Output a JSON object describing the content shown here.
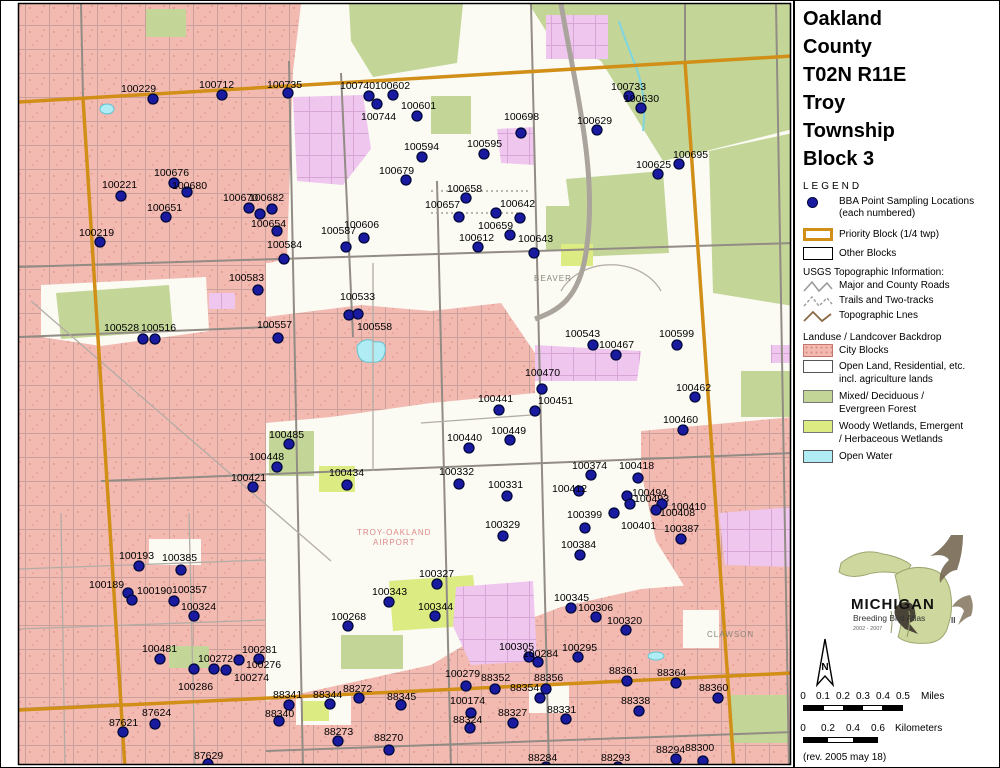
{
  "title": {
    "lines": [
      "Oakland",
      "County",
      "T02N R11E",
      "Troy",
      "Township",
      "Block 3"
    ]
  },
  "legend": {
    "heading": "LEGEND",
    "bba_label": "BBA Point Sampling Locations",
    "bba_sublabel": "(each numbered)",
    "priority_block": "Priority Block (1/4 twp)",
    "other_blocks": "Other Blocks",
    "usgs_heading": "USGS Topographic Information:",
    "usgs_items": [
      "Major and County Roads",
      "Trails and Two-tracks",
      "Topographic Lnes"
    ],
    "landuse_heading": "Landuse / Landcover Backdrop",
    "landuse_items": [
      {
        "label": "City Blocks",
        "color": "#f3bab2"
      },
      {
        "label": "Open Land, Residential, etc.",
        "label2": "incl. agriculture lands",
        "color": "#ffffff"
      },
      {
        "label": "Mixed/ Deciduous /",
        "label2": "Evergreen Forest",
        "color": "#c3d698"
      },
      {
        "label": "Woody Wetlands, Emergent",
        "label2": "/ Herbaceous Wetlands",
        "color": "#dceb82"
      },
      {
        "label": "Open Water",
        "color": "#b0ecf4"
      }
    ]
  },
  "logo": {
    "name": "MICHIGAN",
    "subtitle": "Breeding Bird Atlas",
    "years": "2002 - 2007",
    "numeral": "II"
  },
  "north": {
    "label": "N"
  },
  "scalebars": {
    "miles": {
      "ticks": [
        "0",
        "0.1",
        "0.2",
        "0.3",
        "0.4",
        "0.5"
      ],
      "unit": "Miles"
    },
    "km": {
      "ticks": [
        "0",
        "0.2",
        "0.4",
        "0.6"
      ],
      "unit": "Kilometers"
    }
  },
  "revision": "(rev. 2005 may 18)",
  "colors": {
    "priority_block": "#d18f17",
    "point_dot": "#1a1aa0",
    "city_block": "#f3bab2",
    "forest": "#c3d698",
    "wetland": "#dcEB82",
    "water": "#b0ecf4",
    "violet": "#eec6ee"
  },
  "map": {
    "place_labels": [
      {
        "text": "BEAVER",
        "x": 533,
        "y": 280,
        "color": "#8a8478"
      },
      {
        "text": "TROY-OAKLAND",
        "x": 356,
        "y": 534,
        "color": "#d88"
      },
      {
        "text": "AIRPORT",
        "x": 372,
        "y": 544,
        "color": "#d88"
      },
      {
        "text": "CLAWSON",
        "x": 706,
        "y": 636,
        "color": "#8a8478"
      }
    ],
    "extra_dots": [
      {
        "x": 495,
        "y": 212
      },
      {
        "x": 259,
        "y": 213
      }
    ],
    "points": [
      {
        "id": "100229",
        "x": 152,
        "y": 98,
        "lx": 120,
        "ly": 82
      },
      {
        "id": "100712",
        "x": 221,
        "y": 94,
        "lx": 198,
        "ly": 78
      },
      {
        "id": "100735",
        "x": 287,
        "y": 92,
        "lx": 266,
        "ly": 78
      },
      {
        "id": "100740",
        "x": 368,
        "y": 95,
        "lx": 339,
        "ly": 79
      },
      {
        "id": "100602",
        "x": 392,
        "y": 94,
        "lx": 374,
        "ly": 79
      },
      {
        "id": "100744",
        "x": 376,
        "y": 103,
        "lx": 360,
        "ly": 110
      },
      {
        "id": "100601",
        "x": 416,
        "y": 115,
        "lx": 400,
        "ly": 99
      },
      {
        "id": "100733",
        "x": 628,
        "y": 95,
        "lx": 610,
        "ly": 80
      },
      {
        "id": "100630",
        "x": 640,
        "y": 107,
        "lx": 623,
        "ly": 92
      },
      {
        "id": "100629",
        "x": 596,
        "y": 129,
        "lx": 576,
        "ly": 114
      },
      {
        "id": "100698",
        "x": 520,
        "y": 132,
        "lx": 503,
        "ly": 110
      },
      {
        "id": "100695",
        "x": 678,
        "y": 163,
        "lx": 672,
        "ly": 148
      },
      {
        "id": "100625",
        "x": 657,
        "y": 173,
        "lx": 635,
        "ly": 158
      },
      {
        "id": "100594",
        "x": 421,
        "y": 156,
        "lx": 403,
        "ly": 140
      },
      {
        "id": "100595",
        "x": 483,
        "y": 153,
        "lx": 466,
        "ly": 137
      },
      {
        "id": "100679",
        "x": 405,
        "y": 179,
        "lx": 378,
        "ly": 164
      },
      {
        "id": "100658",
        "x": 465,
        "y": 197,
        "lx": 446,
        "ly": 182
      },
      {
        "id": "100657",
        "x": 458,
        "y": 216,
        "lx": 424,
        "ly": 198
      },
      {
        "id": "100642",
        "x": 519,
        "y": 217,
        "lx": 499,
        "ly": 197
      },
      {
        "id": "100659",
        "x": 509,
        "y": 234,
        "lx": 477,
        "ly": 219
      },
      {
        "id": "100612",
        "x": 477,
        "y": 246,
        "lx": 458,
        "ly": 231
      },
      {
        "id": "100643",
        "x": 533,
        "y": 252,
        "lx": 517,
        "ly": 232
      },
      {
        "id": "100676",
        "x": 173,
        "y": 182,
        "lx": 153,
        "ly": 166
      },
      {
        "id": "100680",
        "x": 186,
        "y": 191,
        "lx": 171,
        "ly": 179
      },
      {
        "id": "100651",
        "x": 165,
        "y": 216,
        "lx": 146,
        "ly": 201
      },
      {
        "id": "100221",
        "x": 120,
        "y": 195,
        "lx": 101,
        "ly": 178
      },
      {
        "id": "100219",
        "x": 99,
        "y": 241,
        "lx": 78,
        "ly": 226
      },
      {
        "id": "100670",
        "x": 248,
        "y": 207,
        "lx": 222,
        "ly": 191
      },
      {
        "id": "100682",
        "x": 271,
        "y": 208,
        "lx": 248,
        "ly": 191
      },
      {
        "id": "100654",
        "x": 276,
        "y": 230,
        "lx": 250,
        "ly": 217
      },
      {
        "id": "100606",
        "x": 363,
        "y": 237,
        "lx": 343,
        "ly": 218
      },
      {
        "id": "100587",
        "x": 345,
        "y": 246,
        "lx": 320,
        "ly": 224
      },
      {
        "id": "100584",
        "x": 283,
        "y": 258,
        "lx": 266,
        "ly": 238
      },
      {
        "id": "100583",
        "x": 257,
        "y": 289,
        "lx": 228,
        "ly": 271
      },
      {
        "id": "100533",
        "x": 348,
        "y": 314,
        "lx": 339,
        "ly": 290
      },
      {
        "id": "100558",
        "x": 357,
        "y": 313,
        "lx": 356,
        "ly": 320
      },
      {
        "id": "100557",
        "x": 277,
        "y": 337,
        "lx": 256,
        "ly": 318
      },
      {
        "id": "100528",
        "x": 142,
        "y": 338,
        "lx": 103,
        "ly": 321
      },
      {
        "id": "100516",
        "x": 154,
        "y": 338,
        "lx": 140,
        "ly": 321
      },
      {
        "id": "100543",
        "x": 592,
        "y": 344,
        "lx": 564,
        "ly": 327
      },
      {
        "id": "100467",
        "x": 615,
        "y": 354,
        "lx": 598,
        "ly": 338
      },
      {
        "id": "100599",
        "x": 676,
        "y": 344,
        "lx": 658,
        "ly": 327
      },
      {
        "id": "100470",
        "x": 541,
        "y": 388,
        "lx": 524,
        "ly": 366
      },
      {
        "id": "100451",
        "x": 534,
        "y": 410,
        "lx": 537,
        "ly": 394
      },
      {
        "id": "100462",
        "x": 694,
        "y": 396,
        "lx": 675,
        "ly": 381
      },
      {
        "id": "100460",
        "x": 682,
        "y": 429,
        "lx": 662,
        "ly": 413
      },
      {
        "id": "100441",
        "x": 498,
        "y": 409,
        "lx": 477,
        "ly": 392
      },
      {
        "id": "100449",
        "x": 509,
        "y": 439,
        "lx": 490,
        "ly": 424
      },
      {
        "id": "100440",
        "x": 468,
        "y": 447,
        "lx": 446,
        "ly": 431
      },
      {
        "id": "100485",
        "x": 288,
        "y": 443,
        "lx": 268,
        "ly": 428
      },
      {
        "id": "100448",
        "x": 276,
        "y": 466,
        "lx": 248,
        "ly": 450
      },
      {
        "id": "100421",
        "x": 252,
        "y": 486,
        "lx": 230,
        "ly": 471
      },
      {
        "id": "100434",
        "x": 346,
        "y": 484,
        "lx": 328,
        "ly": 466
      },
      {
        "id": "100332",
        "x": 458,
        "y": 483,
        "lx": 438,
        "ly": 465
      },
      {
        "id": "100331",
        "x": 506,
        "y": 495,
        "lx": 487,
        "ly": 478
      },
      {
        "id": "100374",
        "x": 590,
        "y": 474,
        "lx": 571,
        "ly": 459
      },
      {
        "id": "100418",
        "x": 637,
        "y": 477,
        "lx": 618,
        "ly": 459
      },
      {
        "id": "100412",
        "x": 578,
        "y": 490,
        "lx": 551,
        "ly": 482
      },
      {
        "id": "100494",
        "x": 626,
        "y": 495,
        "lx": 631,
        "ly": 486
      },
      {
        "id": "100493",
        "x": 629,
        "y": 503,
        "lx": 633,
        "ly": 492
      },
      {
        "id": "100410",
        "x": 661,
        "y": 503,
        "lx": 670,
        "ly": 500
      },
      {
        "id": "100408",
        "x": 655,
        "y": 509,
        "lx": 659,
        "ly": 506
      },
      {
        "id": "100401",
        "x": 613,
        "y": 512,
        "lx": 620,
        "ly": 519
      },
      {
        "id": "100399",
        "x": 584,
        "y": 527,
        "lx": 566,
        "ly": 508
      },
      {
        "id": "100387",
        "x": 680,
        "y": 538,
        "lx": 663,
        "ly": 522
      },
      {
        "id": "100384",
        "x": 579,
        "y": 554,
        "lx": 560,
        "ly": 538
      },
      {
        "id": "100329",
        "x": 502,
        "y": 535,
        "lx": 484,
        "ly": 518
      },
      {
        "id": "100327",
        "x": 436,
        "y": 583,
        "lx": 418,
        "ly": 567
      },
      {
        "id": "100343",
        "x": 388,
        "y": 601,
        "lx": 371,
        "ly": 585
      },
      {
        "id": "100344",
        "x": 434,
        "y": 615,
        "lx": 417,
        "ly": 600
      },
      {
        "id": "100268",
        "x": 347,
        "y": 625,
        "lx": 330,
        "ly": 610
      },
      {
        "id": "100305",
        "x": 528,
        "y": 656,
        "lx": 498,
        "ly": 640
      },
      {
        "id": "100345",
        "x": 570,
        "y": 607,
        "lx": 553,
        "ly": 591
      },
      {
        "id": "100306",
        "x": 595,
        "y": 616,
        "lx": 577,
        "ly": 601
      },
      {
        "id": "100320",
        "x": 625,
        "y": 629,
        "lx": 606,
        "ly": 614
      },
      {
        "id": "100295",
        "x": 577,
        "y": 656,
        "lx": 561,
        "ly": 641
      },
      {
        "id": "100284",
        "x": 537,
        "y": 661,
        "lx": 522,
        "ly": 647
      },
      {
        "id": "100193",
        "x": 138,
        "y": 565,
        "lx": 118,
        "ly": 549
      },
      {
        "id": "100385",
        "x": 180,
        "y": 569,
        "lx": 161,
        "ly": 551
      },
      {
        "id": "100189",
        "x": 127,
        "y": 592,
        "lx": 88,
        "ly": 578
      },
      {
        "id": "100190",
        "x": 131,
        "y": 599,
        "lx": 136,
        "ly": 584
      },
      {
        "id": "100357",
        "x": 173,
        "y": 600,
        "lx": 171,
        "ly": 583
      },
      {
        "id": "100324",
        "x": 193,
        "y": 615,
        "lx": 180,
        "ly": 600
      },
      {
        "id": "100481",
        "x": 159,
        "y": 658,
        "lx": 141,
        "ly": 642
      },
      {
        "id": "100272",
        "x": 213,
        "y": 668,
        "lx": 197,
        "ly": 652
      },
      {
        "id": "100281",
        "x": 258,
        "y": 658,
        "lx": 241,
        "ly": 643
      },
      {
        "id": "100276",
        "x": 238,
        "y": 659,
        "lx": 245,
        "ly": 658
      },
      {
        "id": "100274",
        "x": 225,
        "y": 669,
        "lx": 233,
        "ly": 671
      },
      {
        "id": "100286",
        "x": 193,
        "y": 668,
        "lx": 177,
        "ly": 680
      },
      {
        "id": "87621",
        "x": 122,
        "y": 731,
        "lx": 108,
        "ly": 716
      },
      {
        "id": "87624",
        "x": 154,
        "y": 723,
        "lx": 141,
        "ly": 706
      },
      {
        "id": "87629",
        "x": 207,
        "y": 763,
        "lx": 193,
        "ly": 749
      },
      {
        "id": "88341",
        "x": 288,
        "y": 704,
        "lx": 272,
        "ly": 688
      },
      {
        "id": "88344",
        "x": 329,
        "y": 703,
        "lx": 312,
        "ly": 688
      },
      {
        "id": "88272",
        "x": 358,
        "y": 697,
        "lx": 342,
        "ly": 682
      },
      {
        "id": "88345",
        "x": 400,
        "y": 704,
        "lx": 386,
        "ly": 690
      },
      {
        "id": "88340",
        "x": 278,
        "y": 720,
        "lx": 264,
        "ly": 707
      },
      {
        "id": "88273",
        "x": 337,
        "y": 740,
        "lx": 323,
        "ly": 725
      },
      {
        "id": "88270",
        "x": 388,
        "y": 749,
        "lx": 373,
        "ly": 731
      },
      {
        "id": "100279",
        "x": 465,
        "y": 685,
        "lx": 444,
        "ly": 667
      },
      {
        "id": "88352",
        "x": 494,
        "y": 688,
        "lx": 480,
        "ly": 671
      },
      {
        "id": "88354",
        "x": 545,
        "y": 688,
        "lx": 509,
        "ly": 681
      },
      {
        "id": "88356",
        "x": 539,
        "y": 697,
        "lx": 533,
        "ly": 671
      },
      {
        "id": "100174",
        "x": 470,
        "y": 712,
        "lx": 449,
        "ly": 694
      },
      {
        "id": "88324",
        "x": 469,
        "y": 727,
        "lx": 452,
        "ly": 713
      },
      {
        "id": "88327",
        "x": 512,
        "y": 722,
        "lx": 497,
        "ly": 706
      },
      {
        "id": "88361",
        "x": 626,
        "y": 680,
        "lx": 608,
        "ly": 664
      },
      {
        "id": "88364",
        "x": 675,
        "y": 682,
        "lx": 656,
        "ly": 666
      },
      {
        "id": "88360",
        "x": 717,
        "y": 697,
        "lx": 698,
        "ly": 681
      },
      {
        "id": "88338",
        "x": 638,
        "y": 710,
        "lx": 620,
        "ly": 694
      },
      {
        "id": "88331",
        "x": 565,
        "y": 718,
        "lx": 546,
        "ly": 703
      },
      {
        "id": "88300",
        "x": 702,
        "y": 760,
        "lx": 684,
        "ly": 741
      },
      {
        "id": "88294",
        "x": 675,
        "y": 758,
        "lx": 655,
        "ly": 743
      },
      {
        "id": "88293",
        "x": 617,
        "y": 766,
        "lx": 600,
        "ly": 751
      },
      {
        "id": "88284",
        "x": 545,
        "y": 766,
        "lx": 527,
        "ly": 751
      }
    ]
  }
}
